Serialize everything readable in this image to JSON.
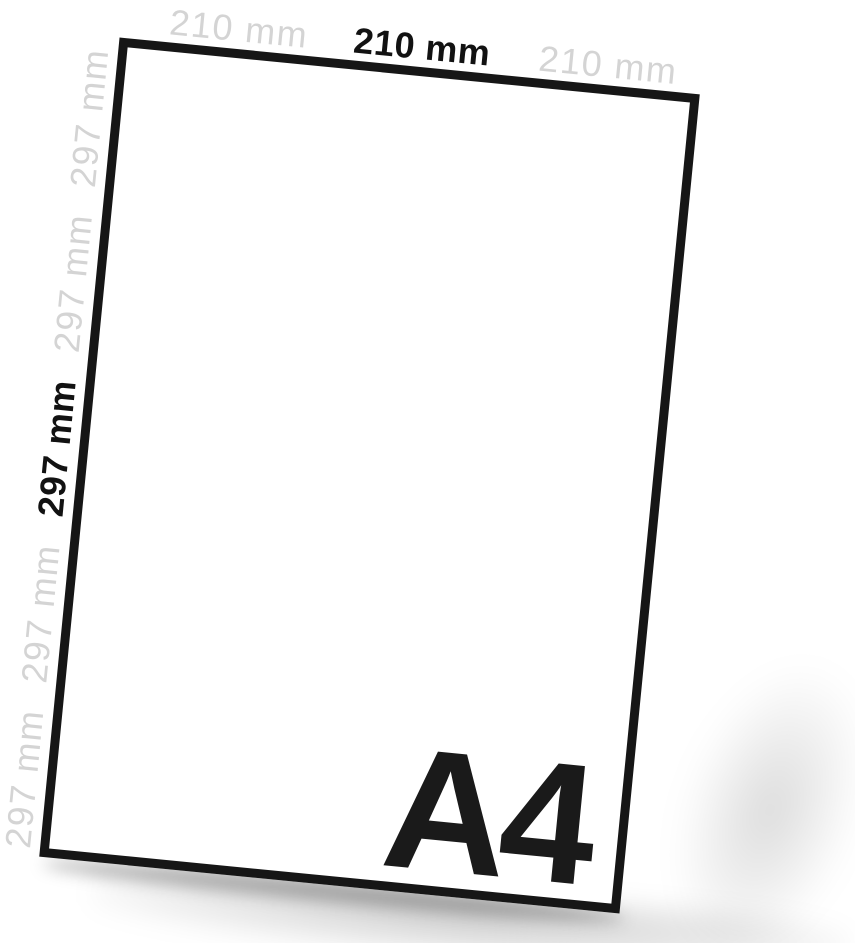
{
  "scene": {
    "format_name": "A4",
    "top_edge_labels": [
      "210 mm",
      "210 mm",
      "210 mm"
    ],
    "left_edge_labels": [
      "297 mm",
      "297 mm",
      "297 mm",
      "297 mm",
      "297 mm"
    ],
    "emphasized_top_index": 1,
    "emphasized_left_index": 2,
    "colors": {
      "ink": "#141414",
      "muted_label": "#d4d4d4",
      "paper_fill": "#ffffff",
      "paper_border": "#161616",
      "background": "#ffffff"
    }
  }
}
